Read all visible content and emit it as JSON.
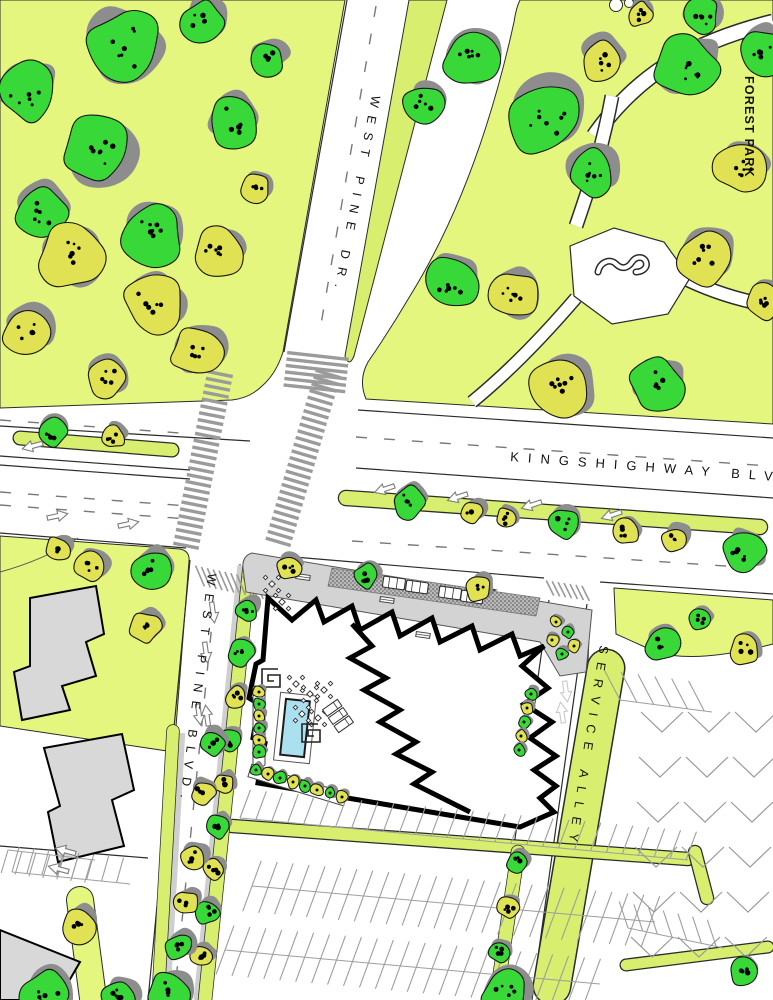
{
  "labels": {
    "west_pine_dr": "WEST PINE DR.",
    "forest_park": "FOREST PARK",
    "kingshighway": "KINGSHIGHWAY BLVD",
    "west_pine_blvd": "WEST PINE BLVD.",
    "service_alley": "SERVICE ALLEY"
  },
  "colors": {
    "lawn": "#e4f67e",
    "median": "#d7ee6e",
    "tree_green": "#38d838",
    "tree_yellow": "#e0e253",
    "shadow": "#8d8d8d",
    "building_gray": "#d8d8d8",
    "plaza_gray": "#d3d3d3",
    "pool_blue": "#abe0ef",
    "road_line": "#2b2b2b"
  },
  "map": {
    "trees": [
      [
        125,
        48,
        40,
        "g"
      ],
      [
        26,
        92,
        30,
        "g"
      ],
      [
        96,
        152,
        36,
        "g"
      ],
      [
        40,
        212,
        27,
        "g"
      ],
      [
        152,
        233,
        33,
        "g"
      ],
      [
        232,
        122,
        27,
        "g"
      ],
      [
        203,
        22,
        22,
        "g"
      ],
      [
        268,
        58,
        18,
        "g"
      ],
      [
        70,
        256,
        34,
        "y"
      ],
      [
        152,
        303,
        30,
        "y"
      ],
      [
        26,
        332,
        24,
        "y"
      ],
      [
        218,
        253,
        25,
        "y"
      ],
      [
        196,
        352,
        26,
        "y"
      ],
      [
        106,
        377,
        20,
        "y"
      ],
      [
        256,
        188,
        15,
        "y"
      ],
      [
        470,
        58,
        28,
        "g"
      ],
      [
        545,
        118,
        38,
        "g"
      ],
      [
        590,
        172,
        25,
        "g"
      ],
      [
        686,
        68,
        33,
        "g"
      ],
      [
        762,
        52,
        24,
        "g"
      ],
      [
        424,
        104,
        20,
        "g"
      ],
      [
        452,
        284,
        28,
        "g"
      ],
      [
        656,
        386,
        28,
        "g"
      ],
      [
        700,
        16,
        20,
        "g"
      ],
      [
        600,
        60,
        22,
        "y"
      ],
      [
        514,
        296,
        26,
        "y"
      ],
      [
        562,
        386,
        32,
        "y"
      ],
      [
        740,
        168,
        26,
        "y"
      ],
      [
        704,
        258,
        28,
        "y"
      ],
      [
        640,
        14,
        13,
        "y"
      ],
      [
        764,
        300,
        20,
        "y"
      ],
      [
        52,
        432,
        15,
        "g"
      ],
      [
        114,
        437,
        12,
        "y"
      ],
      [
        408,
        502,
        17,
        "g"
      ],
      [
        472,
        512,
        12,
        "y"
      ],
      [
        506,
        518,
        11,
        "y"
      ],
      [
        564,
        524,
        15,
        "g"
      ],
      [
        626,
        532,
        13,
        "y"
      ],
      [
        676,
        540,
        14,
        "y"
      ],
      [
        744,
        552,
        22,
        "g"
      ],
      [
        58,
        549,
        13,
        "y"
      ],
      [
        90,
        566,
        17,
        "y"
      ],
      [
        150,
        570,
        21,
        "g"
      ],
      [
        145,
        628,
        16,
        "y"
      ],
      [
        662,
        644,
        19,
        "g"
      ],
      [
        745,
        650,
        16,
        "y"
      ],
      [
        700,
        620,
        11,
        "g"
      ],
      [
        246,
        610,
        12,
        "g"
      ],
      [
        241,
        653,
        13,
        "g"
      ],
      [
        235,
        697,
        11,
        "y"
      ],
      [
        229,
        741,
        12,
        "g"
      ],
      [
        224,
        784,
        11,
        "y"
      ],
      [
        218,
        827,
        12,
        "g"
      ],
      [
        213,
        870,
        11,
        "y"
      ],
      [
        208,
        913,
        12,
        "g"
      ],
      [
        202,
        956,
        11,
        "y"
      ],
      [
        212,
        743,
        14,
        "g"
      ],
      [
        203,
        793,
        13,
        "y"
      ],
      [
        193,
        858,
        13,
        "y"
      ],
      [
        186,
        903,
        13,
        "y"
      ],
      [
        179,
        947,
        14,
        "g"
      ],
      [
        168,
        992,
        22,
        "g"
      ],
      [
        78,
        925,
        18,
        "y"
      ],
      [
        45,
        996,
        26,
        "g"
      ],
      [
        120,
        998,
        18,
        "g"
      ],
      [
        517,
        862,
        11,
        "g"
      ],
      [
        508,
        908,
        11,
        "y"
      ],
      [
        499,
        952,
        11,
        "g"
      ],
      [
        505,
        992,
        24,
        "g"
      ],
      [
        742,
        971,
        14,
        "g"
      ],
      [
        289,
        567,
        12,
        "y"
      ],
      [
        366,
        576,
        13,
        "g"
      ],
      [
        478,
        589,
        13,
        "y"
      ]
    ],
    "shrubs": [
      [
        259,
        692,
        "y"
      ],
      [
        259,
        704,
        "g"
      ],
      [
        259,
        716,
        "y"
      ],
      [
        259,
        728,
        "g"
      ],
      [
        259,
        740,
        "y"
      ],
      [
        259,
        752,
        "g"
      ],
      [
        256,
        770,
        "g"
      ],
      [
        268,
        774,
        "y"
      ],
      [
        280,
        778,
        "g"
      ],
      [
        293,
        782,
        "y"
      ],
      [
        305,
        786,
        "g"
      ],
      [
        317,
        790,
        "y"
      ],
      [
        330,
        793,
        "g"
      ],
      [
        342,
        797,
        "y"
      ],
      [
        556,
        622,
        "y"
      ],
      [
        568,
        632,
        "g"
      ],
      [
        574,
        646,
        "y"
      ],
      [
        562,
        654,
        "g"
      ],
      [
        552,
        640,
        "y"
      ],
      [
        531,
        694,
        "g"
      ],
      [
        527,
        708,
        "y"
      ],
      [
        524,
        722,
        "g"
      ],
      [
        521,
        736,
        "y"
      ],
      [
        519,
        750,
        "g"
      ]
    ],
    "crosswalks": [
      {
        "x1": 220,
        "y1": 374,
        "x2": 186,
        "y2": 546,
        "w": 26,
        "step": 7
      },
      {
        "x1": 328,
        "y1": 374,
        "x2": 277,
        "y2": 546,
        "w": 26,
        "step": 7
      },
      {
        "x1": 318,
        "y1": 356,
        "x2": 314,
        "y2": 392,
        "w": 62,
        "step": 6.5
      }
    ],
    "hatches": [
      {
        "x1": 200,
        "y1": 576,
        "x2": 266,
        "y2": 590,
        "w": 16,
        "step": 6
      },
      {
        "x1": 550,
        "y1": 588,
        "x2": 590,
        "y2": 594,
        "w": 12,
        "step": 6
      }
    ],
    "combs": [
      {
        "x1": 240,
        "y1": 818,
        "x2": 688,
        "y2": 860,
        "step": 16,
        "len": 30,
        "side": -1,
        "slant": 15
      },
      {
        "x1": 252,
        "y1": 886,
        "x2": 655,
        "y2": 922,
        "step": 16,
        "len": 27,
        "side": 2,
        "slant": 15
      },
      {
        "x1": 225,
        "y1": 950,
        "x2": 600,
        "y2": 984,
        "step": 16,
        "len": 26,
        "side": 2,
        "slant": 15
      },
      {
        "x1": 12,
        "y1": 872,
        "x2": 130,
        "y2": 884,
        "step": 15,
        "len": 26,
        "side": -1,
        "slant": 10
      },
      {
        "x1": 620,
        "y1": 700,
        "x2": 712,
        "y2": 712,
        "step": 17,
        "len": 34,
        "side": -1,
        "slant": -35
      },
      {
        "x1": 628,
        "y1": 928,
        "x2": 724,
        "y2": 948,
        "step": 15,
        "len": 28,
        "side": -1,
        "slant": -30
      },
      {
        "x1": 8,
        "y1": 850,
        "x2": 95,
        "y2": 860,
        "step": 14,
        "len": 24,
        "side": 1,
        "slant": 10
      }
    ],
    "chevrons": {
      "x0": 662,
      "y0": 712,
      "cols": 3,
      "rows": 6,
      "dx": 47,
      "dy": 45,
      "half": 21,
      "depth": 20,
      "drift": -2
    },
    "dashes": [
      [
        0,
        420,
        180,
        433
      ],
      [
        0,
        492,
        188,
        506
      ],
      [
        0,
        505,
        188,
        519
      ],
      [
        356,
        437,
        770,
        466
      ],
      [
        352,
        541,
        770,
        569
      ],
      [
        376,
        6,
        320,
        330
      ],
      [
        214,
        604,
        174,
        1000
      ]
    ],
    "arrows": [
      [
        33,
        446,
        255
      ],
      [
        57,
        516,
        78
      ],
      [
        128,
        524,
        78
      ],
      [
        385,
        489,
        252
      ],
      [
        458,
        497,
        252
      ],
      [
        532,
        505,
        252
      ],
      [
        612,
        515,
        252
      ],
      [
        213,
        612,
        172
      ],
      [
        206,
        652,
        172
      ],
      [
        199,
        714,
        172
      ],
      [
        207,
        716,
        352
      ],
      [
        66,
        851,
        285
      ],
      [
        59,
        869,
        285
      ],
      [
        566,
        691,
        172,
        "w"
      ],
      [
        562,
        713,
        352,
        "w"
      ]
    ],
    "cars": [
      [
        394,
        583
      ],
      [
        417,
        587
      ],
      [
        450,
        593
      ],
      [
        472,
        597
      ]
    ],
    "car_rotation": 8,
    "furniture": {
      "tables": [
        [
          272,
          584
        ],
        [
          282,
          602
        ],
        [
          296,
          684
        ],
        [
          310,
          694
        ],
        [
          324,
          690
        ],
        [
          302,
          714
        ],
        [
          318,
          718
        ]
      ],
      "spirals": [
        [
          271,
          678
        ],
        [
          311,
          733
        ]
      ],
      "loungers": {
        "x": 338,
        "y": 716,
        "rot": 55
      },
      "benches": [
        [
          303,
          577
        ],
        [
          387,
          600
        ],
        [
          423,
          635
        ]
      ]
    }
  }
}
